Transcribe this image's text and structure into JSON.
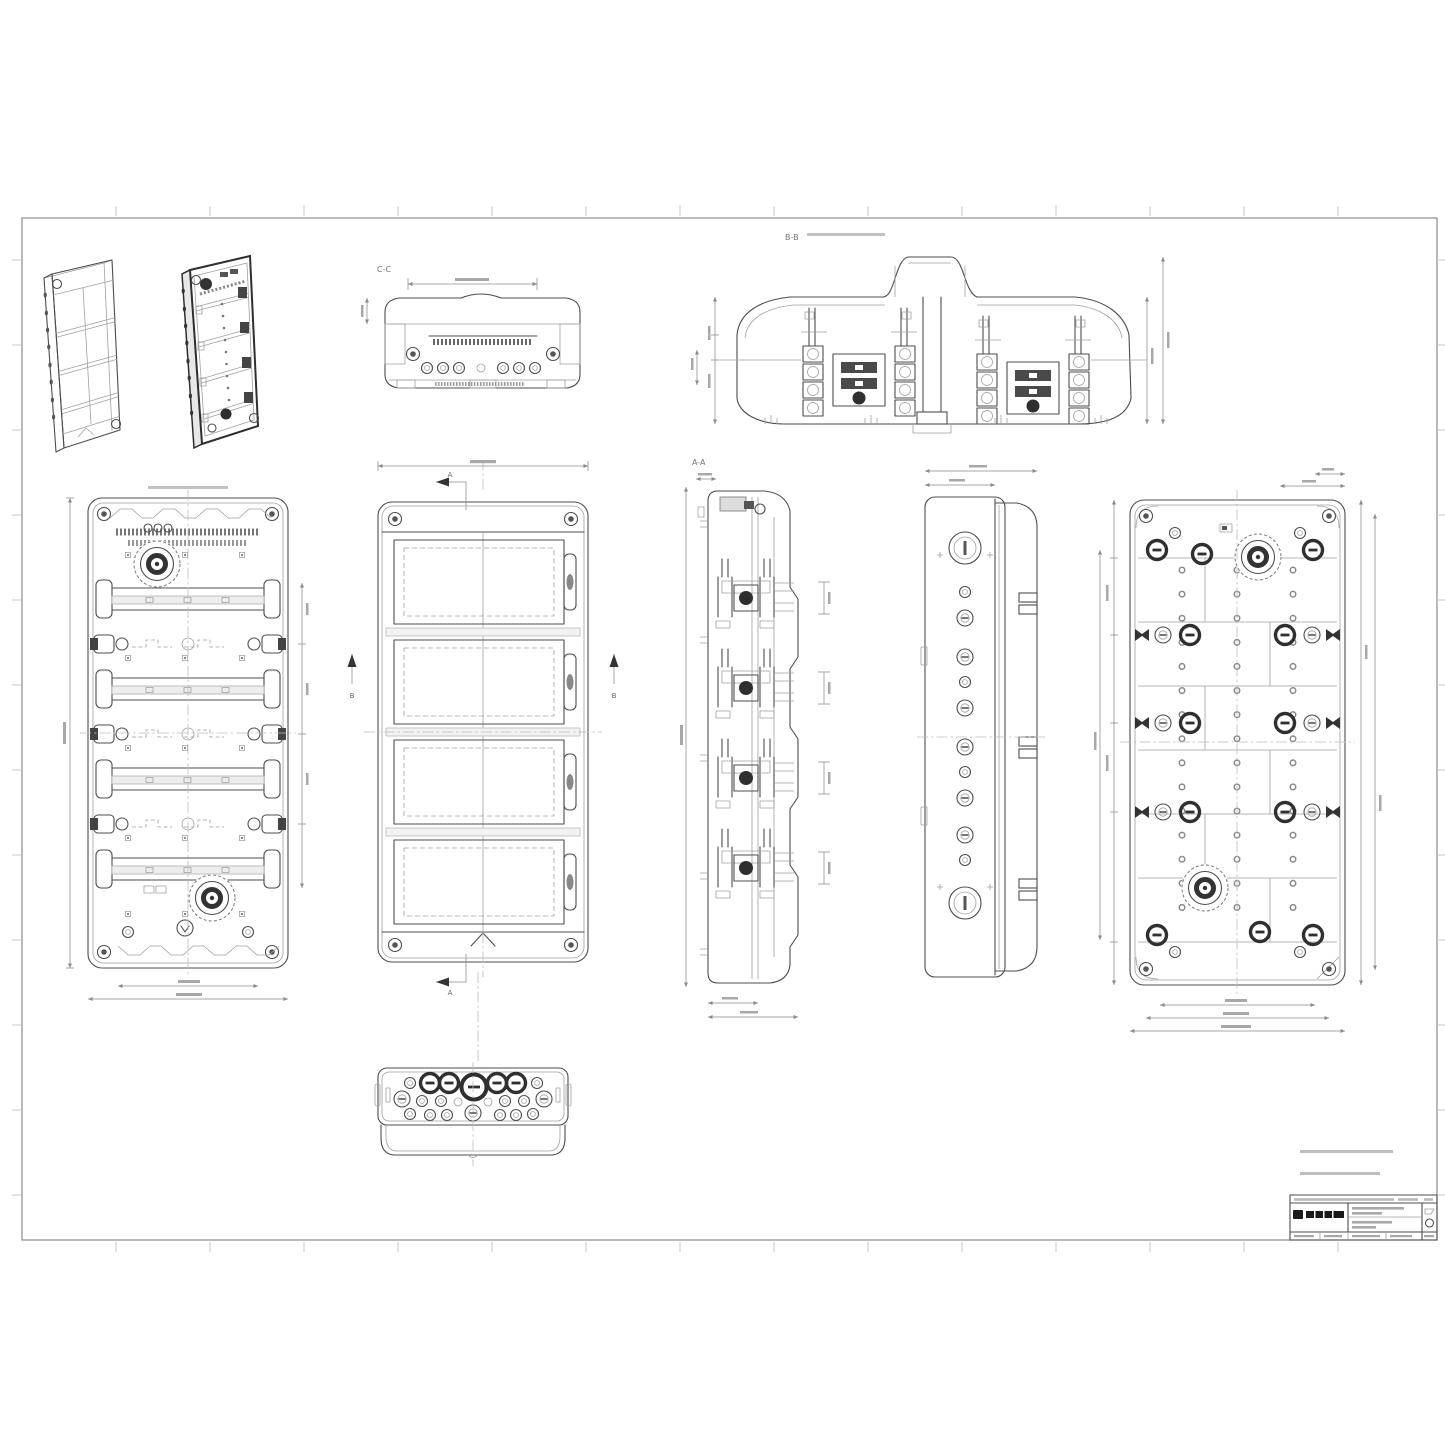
{
  "sheet": {
    "background": "#ffffff",
    "frame_color": "#8c8c8c",
    "line_color": "#4d4d4d",
    "light_line_color": "#a0a0a0",
    "dark_fill": "#2f2f2f",
    "dim_color": "#8a8a8a"
  },
  "labels": {
    "section_cc": "C-C",
    "section_bb": "B-B",
    "section_aa": "A-A",
    "cut_arrow_top": "A",
    "cut_arrow_bottom": "A",
    "cut_arrow_left": "B",
    "cut_arrow_right": "B"
  }
}
